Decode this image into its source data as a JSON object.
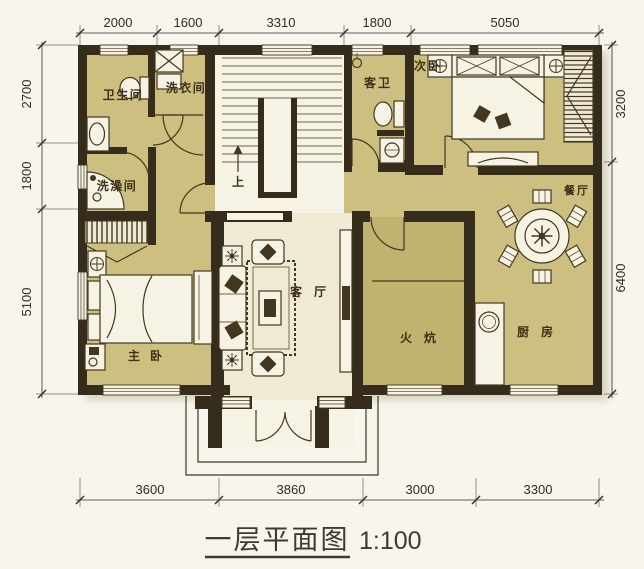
{
  "title": {
    "name": "一层平面图",
    "scale": "1:100"
  },
  "rooms": {
    "bathroom": "卫生间",
    "laundry": "洗衣间",
    "shower": "洗澡间",
    "guest_bath": "客卫",
    "second_bedroom": "次卧",
    "dining": "餐厅",
    "master_bedroom": "主卧",
    "living": "客厅",
    "kang": "火炕",
    "kitchen": "厨房"
  },
  "stairs": {
    "direction_label": "上"
  },
  "dimensions_mm": {
    "top": [
      "2000",
      "1600",
      "3310",
      "1800",
      "5050"
    ],
    "left": [
      "2700",
      "1800",
      "5100"
    ],
    "right": [
      "3200",
      "6400"
    ],
    "bottom": [
      "3600",
      "3860",
      "3000",
      "3300"
    ]
  },
  "colors": {
    "bg": "#f8f5ec",
    "floor": "#cdbf80",
    "floor_dark": "#c2b270",
    "floor_light": "#f0e9d3",
    "fixture": "#f7f3e4",
    "wall": "#352c1b",
    "ink": "#43381f",
    "label": "#3d3118",
    "dim": "#2e2c28",
    "title": "#3f3b33"
  }
}
